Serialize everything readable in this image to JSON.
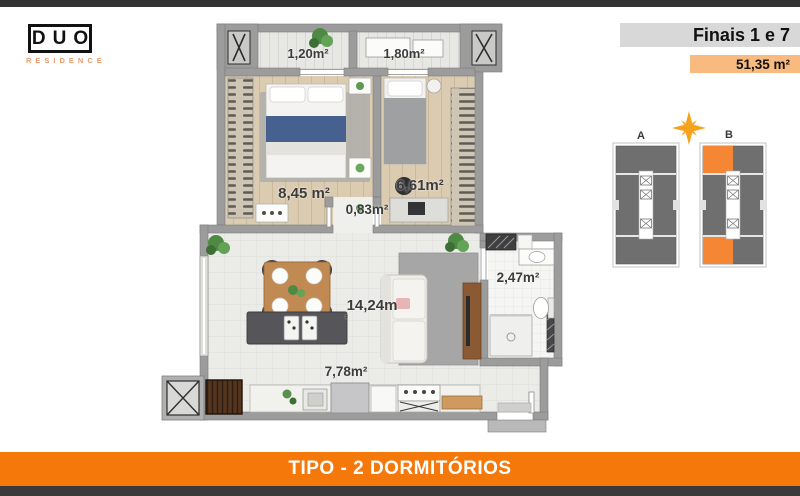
{
  "brand": {
    "name": "DUO",
    "tagline": "RESIDENCE"
  },
  "header": {
    "units_label": "Finais 1 e 7",
    "total_area": "51,35 m²"
  },
  "keyplan": {
    "tower_a": "A",
    "tower_b": "B"
  },
  "floorplan": {
    "rooms": [
      {
        "id": "balcony-1",
        "area": "1,20m²"
      },
      {
        "id": "balcony-2",
        "area": "1,80m²"
      },
      {
        "id": "bedroom-1",
        "area": "8,45 m²"
      },
      {
        "id": "bedroom-2",
        "area": "6,61m²"
      },
      {
        "id": "hall",
        "area": "0,83m²"
      },
      {
        "id": "living",
        "area": "14,24m",
        "area_sup": "²"
      },
      {
        "id": "bathroom",
        "area": "2,47m²"
      },
      {
        "id": "kitchen",
        "area": "7,78m²"
      }
    ]
  },
  "footer": {
    "title": "TIPO - 2 DORMITÓRIOS"
  },
  "colors": {
    "top_bar": "#333333",
    "accent_orange": "#F5790A",
    "chip_orange": "#F9BA80",
    "header_gray": "#D8D8D8",
    "highlight_orange": "#F58634",
    "star_gold": "#F6A21D",
    "wall_gray": "#9C9C9C",
    "tower_gray": "#6F6F70"
  }
}
